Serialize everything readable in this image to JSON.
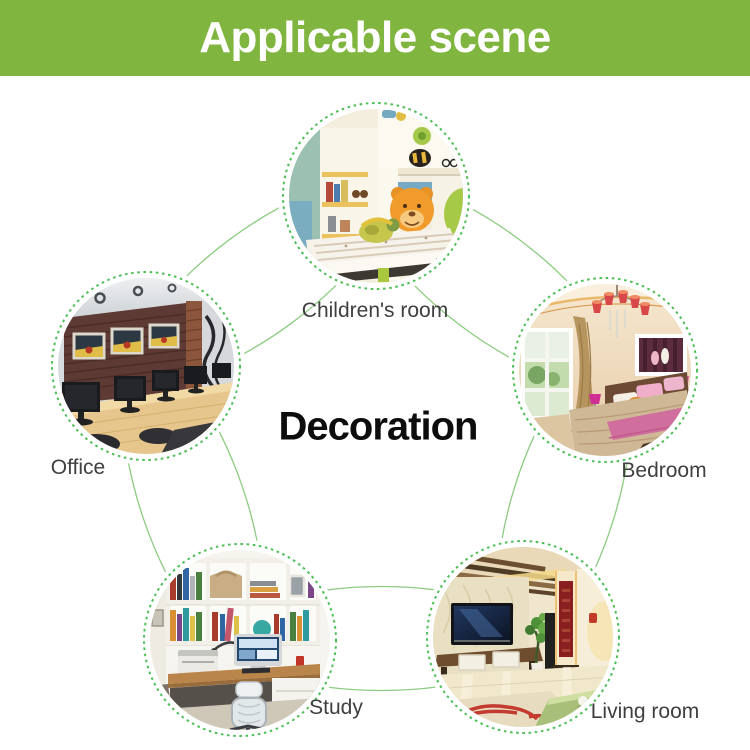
{
  "header": {
    "title": "Applicable scene"
  },
  "center_title": "Decoration",
  "scenes": [
    {
      "id": "children-room",
      "label": "Children's room"
    },
    {
      "id": "office",
      "label": "Office"
    },
    {
      "id": "bedroom",
      "label": "Bedroom"
    },
    {
      "id": "study",
      "label": "Study"
    },
    {
      "id": "living-room",
      "label": "Living room"
    }
  ],
  "colors": {
    "header_bg": "#80b640",
    "header_text": "#ffffff",
    "connector_line": "#8ccc80",
    "dashed_ring": "#4ebf58",
    "label_text": "#3f3f3f",
    "center_text": "#0d0d0d"
  }
}
